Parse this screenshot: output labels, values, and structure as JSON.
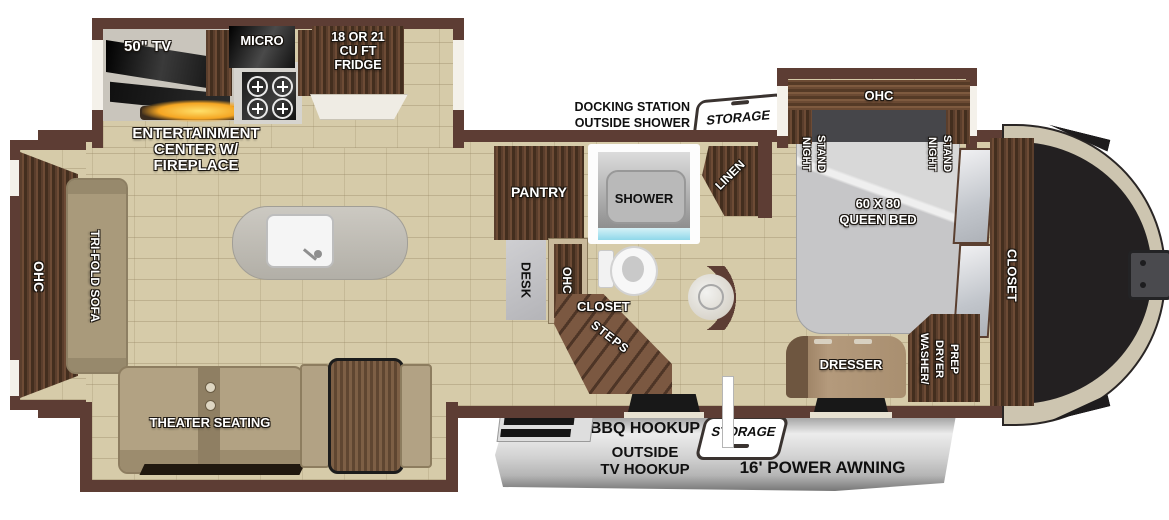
{
  "fp": {
    "exterior": {
      "docking_line1": "DOCKING STATION",
      "docking_line2": "OUTSIDE SHOWER",
      "storage_top": "STORAGE",
      "storage_bottom": "STORAGE",
      "bbq": "BBQ HOOKUP",
      "outside_tv_line1": "OUTSIDE",
      "outside_tv_line2": "TV HOOKUP",
      "awning": "16' POWER AWNING"
    },
    "kitchen": {
      "tv": "50\" TV",
      "micro": "MICRO",
      "fridge_line1": "18 OR 21",
      "fridge_line2": "CU FT",
      "fridge_line3": "FRIDGE",
      "ent_line1": "ENTERTAINMENT",
      "ent_line2": "CENTER W/",
      "ent_line3": "FIREPLACE",
      "pantry": "PANTRY",
      "desk": "DESK",
      "ohc": "OHC"
    },
    "living": {
      "ohc": "OHC",
      "sofa": "TRI-FOLD SOFA",
      "theater": "THEATER SEATING"
    },
    "bath": {
      "shower": "SHOWER",
      "linen": "LINEN",
      "closet": "CLOSET",
      "steps": "STEPS"
    },
    "bedroom": {
      "ohc": "OHC",
      "nightstand_line1": "NIGHT",
      "nightstand_line2": "STAND",
      "bed_line1": "60 X 80",
      "bed_line2": "QUEEN BED",
      "closet": "CLOSET",
      "dresser": "DRESSER",
      "washer_line1": "WASHER/",
      "washer_line2": "DRYER",
      "washer_line3": "PREP"
    },
    "colors": {
      "wall": "#5d3d34",
      "floor": "#d6cba9",
      "wood_dark": "#4e3526",
      "wood_mid": "#7a5740",
      "awning_silver": "#d9d9d9",
      "fireplace_glow": "#f5a623",
      "shower_blue": "#8fd8ea",
      "cap_dark": "#232021",
      "cap_tan": "#cdc5b0"
    }
  }
}
